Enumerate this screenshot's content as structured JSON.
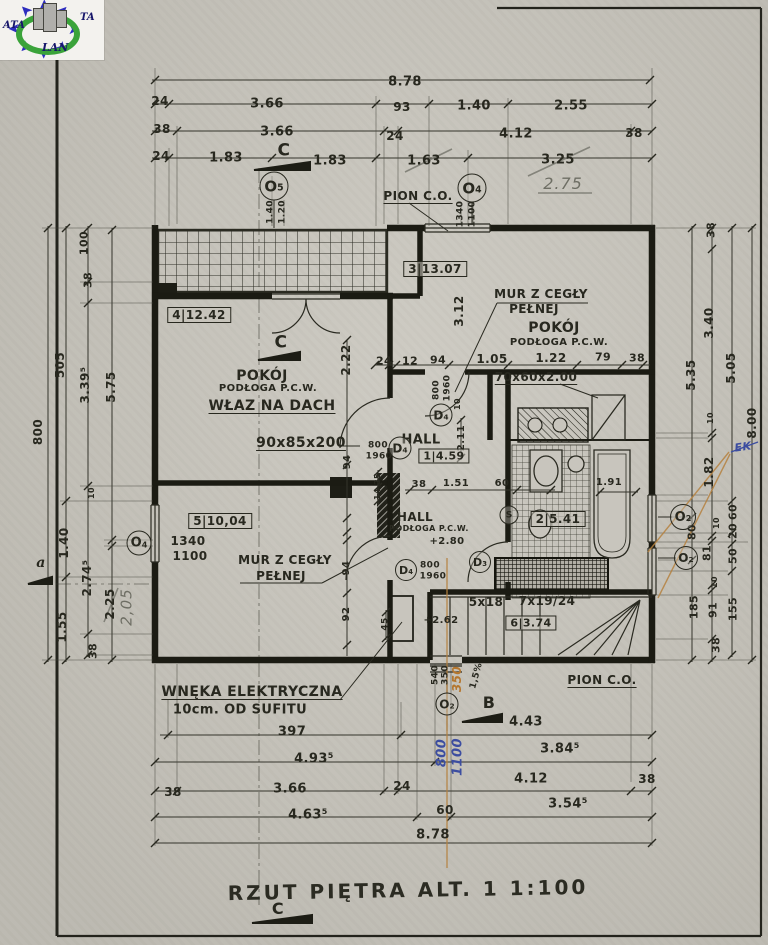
{
  "logo": {
    "text_left": "ATA",
    "text_right": "TA",
    "text_bottom": "LAN"
  },
  "title": {
    "text": "RZUT PIĘTRA ALT. 1  1:100"
  },
  "colors": {
    "paper": "#c8c5bc",
    "ink": "#28281f",
    "pencil": "#6e6e64",
    "blue_ink": "#3c4da0",
    "orange": "#b4762e",
    "logo_blue": "#2d2dbe",
    "logo_green": "#3aa33a"
  },
  "labels": [
    {
      "t": "8.78",
      "x": 405,
      "y": 82,
      "s": 13
    },
    {
      "t": "24",
      "x": 160,
      "y": 101
    },
    {
      "t": "3.66",
      "x": 267,
      "y": 104,
      "s": 13
    },
    {
      "t": "93",
      "x": 402,
      "y": 107
    },
    {
      "t": "1.40",
      "x": 474,
      "y": 106,
      "s": 13
    },
    {
      "t": "2.55",
      "x": 571,
      "y": 106,
      "s": 13
    },
    {
      "t": "38",
      "x": 162,
      "y": 129
    },
    {
      "t": "3.66",
      "x": 277,
      "y": 132,
      "s": 13
    },
    {
      "t": "24",
      "x": 395,
      "y": 136
    },
    {
      "t": "4.12",
      "x": 516,
      "y": 134,
      "s": 13
    },
    {
      "t": "38",
      "x": 634,
      "y": 133
    },
    {
      "t": "24",
      "x": 161,
      "y": 156
    },
    {
      "t": "1.83",
      "x": 226,
      "y": 158,
      "s": 13
    },
    {
      "t": "C",
      "x": 284,
      "y": 151,
      "s": 17,
      "b": 1,
      "n": "section-mark-c-top"
    },
    {
      "t": "1.83",
      "x": 330,
      "y": 161,
      "s": 13
    },
    {
      "t": "1.63",
      "x": 424,
      "y": 161,
      "s": 13
    },
    {
      "t": "3.25",
      "x": 558,
      "y": 160,
      "s": 13
    },
    {
      "t": "2.75",
      "x": 563,
      "y": 184,
      "s": 16,
      "c": "pc",
      "n": "handwritten-correction"
    },
    {
      "t": "PION C.O.",
      "x": 418,
      "y": 196,
      "u": 1,
      "n": "riser-label"
    },
    {
      "t": "1.40",
      "x": 271,
      "y": 212,
      "r": -90,
      "s": 9
    },
    {
      "t": "1.20",
      "x": 283,
      "y": 212,
      "r": -90,
      "s": 9
    },
    {
      "t": "1340",
      "x": 461,
      "y": 214,
      "r": -90,
      "s": 9
    },
    {
      "t": "1100",
      "x": 473,
      "y": 214,
      "r": -90,
      "s": 9
    },
    {
      "t": "3|13.07",
      "x": 435,
      "y": 269,
      "bx": 1,
      "n": "room-tag"
    },
    {
      "t": "MUR Z CEGŁY",
      "x": 541,
      "y": 294,
      "n": "wall-note"
    },
    {
      "t": "PEŁNEJ",
      "x": 534,
      "y": 309,
      "n": "wall-note"
    },
    {
      "t": "POKÓJ",
      "x": 554,
      "y": 328,
      "s": 14,
      "n": "room-name"
    },
    {
      "t": "PODŁOGA P.C.W.",
      "x": 559,
      "y": 343,
      "s": 10,
      "n": "floor-note"
    },
    {
      "t": "3.12",
      "x": 459,
      "y": 311,
      "r": -90
    },
    {
      "t": "24",
      "x": 384,
      "y": 361,
      "s": 11
    },
    {
      "t": "12",
      "x": 410,
      "y": 361,
      "s": 11
    },
    {
      "t": "94",
      "x": 438,
      "y": 360,
      "s": 11
    },
    {
      "t": "1.05",
      "x": 492,
      "y": 359
    },
    {
      "t": "1.22",
      "x": 551,
      "y": 358
    },
    {
      "t": "79",
      "x": 603,
      "y": 357,
      "s": 11
    },
    {
      "t": "38",
      "x": 637,
      "y": 358,
      "s": 11
    },
    {
      "t": "70x60x2.00",
      "x": 536,
      "y": 377,
      "u": 1,
      "n": "duct-size"
    },
    {
      "t": "800",
      "x": 437,
      "y": 390,
      "r": -90,
      "s": 9
    },
    {
      "t": "1960",
      "x": 448,
      "y": 388,
      "r": -90,
      "s": 9
    },
    {
      "t": "10",
      "x": 458,
      "y": 404,
      "r": -90,
      "s": 8
    },
    {
      "t": "2.11",
      "x": 462,
      "y": 438,
      "r": -90,
      "s": 10
    },
    {
      "t": "HALL",
      "x": 421,
      "y": 440,
      "s": 13,
      "n": "room-name"
    },
    {
      "t": "1|4.59",
      "x": 444,
      "y": 456,
      "bx": 1,
      "s": 11,
      "n": "room-tag"
    },
    {
      "t": "800",
      "x": 378,
      "y": 446,
      "s": 9
    },
    {
      "t": "1960",
      "x": 379,
      "y": 457,
      "s": 9
    },
    {
      "t": "38",
      "x": 419,
      "y": 485,
      "s": 10
    },
    {
      "t": "1.51",
      "x": 456,
      "y": 484,
      "s": 10
    },
    {
      "t": "60",
      "x": 502,
      "y": 484,
      "s": 10
    },
    {
      "t": "4|12.42",
      "x": 199,
      "y": 315,
      "bx": 1,
      "n": "room-tag"
    },
    {
      "t": "C",
      "x": 281,
      "y": 343,
      "s": 17,
      "b": 1,
      "n": "section-mark-c"
    },
    {
      "t": "POKÓJ",
      "x": 262,
      "y": 376,
      "s": 14,
      "n": "room-name"
    },
    {
      "t": "PODŁOGA P.C.W.",
      "x": 268,
      "y": 389,
      "s": 10,
      "n": "floor-note"
    },
    {
      "t": "WŁAZ NA DACH",
      "x": 272,
      "y": 406,
      "s": 14,
      "u": 1,
      "n": "roof-hatch-note"
    },
    {
      "t": "90x85x200",
      "x": 301,
      "y": 443,
      "s": 14,
      "u": 1,
      "n": "hatch-size"
    },
    {
      "t": "2.22",
      "x": 346,
      "y": 360,
      "r": -90
    },
    {
      "t": "94",
      "x": 348,
      "y": 462,
      "r": -90,
      "s": 10
    },
    {
      "t": "25",
      "x": 378,
      "y": 479,
      "r": -90,
      "s": 8
    },
    {
      "t": "14",
      "x": 378,
      "y": 494,
      "r": -90,
      "s": 8
    },
    {
      "t": "94",
      "x": 347,
      "y": 568,
      "r": -90,
      "s": 10
    },
    {
      "t": "92",
      "x": 347,
      "y": 614,
      "r": -90,
      "s": 10
    },
    {
      "t": "45",
      "x": 386,
      "y": 624,
      "r": -90,
      "s": 9
    },
    {
      "t": "5|10,04",
      "x": 220,
      "y": 521,
      "bx": 1,
      "n": "room-tag"
    },
    {
      "t": "1340",
      "x": 188,
      "y": 541,
      "n": "window-size"
    },
    {
      "t": "1100",
      "x": 190,
      "y": 556,
      "n": "window-sill"
    },
    {
      "t": "MUR Z CEGŁY",
      "x": 285,
      "y": 560,
      "n": "wall-note"
    },
    {
      "t": "PEŁNEJ",
      "x": 281,
      "y": 576,
      "n": "wall-note"
    },
    {
      "t": "WNĘKA ELEKTRYCZNA",
      "x": 252,
      "y": 692,
      "s": 14,
      "u": 1,
      "n": "niche-note"
    },
    {
      "t": "10cm. OD SUFITU",
      "x": 240,
      "y": 710,
      "s": 13,
      "n": "niche-note"
    },
    {
      "t": "HALL",
      "x": 415,
      "y": 517,
      "n": "room-name"
    },
    {
      "t": "PODŁOGA P.C.W.",
      "x": 429,
      "y": 529,
      "s": 8,
      "n": "floor-note"
    },
    {
      "t": "+2.80",
      "x": 447,
      "y": 542,
      "s": 10,
      "n": "level-mark"
    },
    {
      "t": "800",
      "x": 430,
      "y": 566,
      "s": 9
    },
    {
      "t": "1960",
      "x": 433,
      "y": 577,
      "s": 9
    },
    {
      "t": "2|5.41",
      "x": 558,
      "y": 519,
      "bx": 1,
      "n": "room-tag"
    },
    {
      "t": "1.91",
      "x": 609,
      "y": 483,
      "s": 10
    },
    {
      "t": "+2.62",
      "x": 441,
      "y": 621,
      "s": 10,
      "n": "level-mark"
    },
    {
      "t": "5x18",
      "x": 486,
      "y": 602,
      "n": "stair-note"
    },
    {
      "t": "7x19/24",
      "x": 547,
      "y": 601,
      "n": "stair-note"
    },
    {
      "t": "6|3.74",
      "x": 531,
      "y": 623,
      "bx": 1,
      "s": 11,
      "n": "room-tag"
    },
    {
      "t": "PION C.O.",
      "x": 602,
      "y": 680,
      "u": 1,
      "n": "riser-label"
    },
    {
      "t": "B",
      "x": 489,
      "y": 703,
      "s": 16,
      "b": 1,
      "n": "section-mark-b"
    },
    {
      "t": "1,5%",
      "x": 477,
      "y": 676,
      "r": -75,
      "s": 9,
      "n": "slope-note"
    },
    {
      "t": "540",
      "x": 436,
      "y": 675,
      "r": -90,
      "s": 9
    },
    {
      "t": "350",
      "x": 446,
      "y": 675,
      "r": -90,
      "s": 9
    },
    {
      "t": "350",
      "x": 457,
      "y": 679,
      "r": -90,
      "s": 12,
      "c": "or",
      "n": "handwritten-correction"
    },
    {
      "t": "800",
      "x": 442,
      "y": 753,
      "r": -90,
      "s": 13,
      "c": "bl",
      "n": "handwritten-note"
    },
    {
      "t": "1100",
      "x": 458,
      "y": 757,
      "r": -90,
      "s": 13,
      "c": "bl",
      "n": "handwritten-note"
    },
    {
      "t": "EK",
      "x": 743,
      "y": 447,
      "s": 11,
      "c": "bl",
      "r": -8,
      "n": "handwritten-note"
    },
    {
      "t": "4.43",
      "x": 526,
      "y": 722,
      "s": 13
    },
    {
      "t": "397",
      "x": 292,
      "y": 732,
      "s": 13
    },
    {
      "t": "4.93⁵",
      "x": 314,
      "y": 759,
      "s": 13
    },
    {
      "t": "3.84⁵",
      "x": 560,
      "y": 749,
      "s": 13
    },
    {
      "t": "38",
      "x": 173,
      "y": 792
    },
    {
      "t": "3.66",
      "x": 290,
      "y": 789,
      "s": 13
    },
    {
      "t": "24",
      "x": 402,
      "y": 786
    },
    {
      "t": "4.12",
      "x": 531,
      "y": 779,
      "s": 13
    },
    {
      "t": "38",
      "x": 647,
      "y": 779
    },
    {
      "t": "4.63⁵",
      "x": 308,
      "y": 815,
      "s": 13
    },
    {
      "t": "60",
      "x": 445,
      "y": 810
    },
    {
      "t": "3.54⁵",
      "x": 568,
      "y": 804,
      "s": 13
    },
    {
      "t": "8.78",
      "x": 433,
      "y": 835,
      "s": 13
    },
    {
      "t": "800",
      "x": 38,
      "y": 432,
      "r": -90
    },
    {
      "t": "505",
      "x": 60,
      "y": 365,
      "r": -90
    },
    {
      "t": "100",
      "x": 84,
      "y": 243,
      "r": -90,
      "s": 11
    },
    {
      "t": "38",
      "x": 88,
      "y": 280,
      "r": -90,
      "s": 11
    },
    {
      "t": "3.39⁵",
      "x": 85,
      "y": 385,
      "r": -90
    },
    {
      "t": "5.75",
      "x": 111,
      "y": 387,
      "r": -90
    },
    {
      "t": "10",
      "x": 92,
      "y": 493,
      "r": -90,
      "s": 8
    },
    {
      "t": "1.40",
      "x": 64,
      "y": 543,
      "r": -90
    },
    {
      "t": "2.74⁵",
      "x": 87,
      "y": 578,
      "r": -90
    },
    {
      "t": "2.25",
      "x": 110,
      "y": 604,
      "r": -90
    },
    {
      "t": "2,05",
      "x": 127,
      "y": 607,
      "r": -90,
      "s": 15,
      "c": "pc",
      "n": "handwritten-correction"
    },
    {
      "t": "1.55",
      "x": 62,
      "y": 627,
      "r": -90
    },
    {
      "t": "38",
      "x": 93,
      "y": 651,
      "r": -90,
      "s": 11
    },
    {
      "t": "a",
      "x": 41,
      "y": 563,
      "s": 14,
      "c": "ax",
      "n": "axis-mark-a"
    },
    {
      "t": "5.35",
      "x": 691,
      "y": 375,
      "r": -90
    },
    {
      "t": "80",
      "x": 692,
      "y": 532,
      "r": -90,
      "s": 11
    },
    {
      "t": "185",
      "x": 694,
      "y": 607,
      "r": -90,
      "s": 11
    },
    {
      "t": "38",
      "x": 711,
      "y": 230,
      "r": -90,
      "s": 11
    },
    {
      "t": "3.40",
      "x": 709,
      "y": 323,
      "r": -90
    },
    {
      "t": "10",
      "x": 711,
      "y": 418,
      "r": -90,
      "s": 8
    },
    {
      "t": "1.82",
      "x": 709,
      "y": 472,
      "r": -90
    },
    {
      "t": "10",
      "x": 717,
      "y": 523,
      "r": -90,
      "s": 8
    },
    {
      "t": "81",
      "x": 707,
      "y": 553,
      "r": -90,
      "s": 11
    },
    {
      "t": "10",
      "x": 715,
      "y": 582,
      "r": -90,
      "s": 8
    },
    {
      "t": "91",
      "x": 713,
      "y": 610,
      "r": -90,
      "s": 11
    },
    {
      "t": "38",
      "x": 716,
      "y": 645,
      "r": -90,
      "s": 11
    },
    {
      "t": "5.05",
      "x": 731,
      "y": 368,
      "r": -90
    },
    {
      "t": "60",
      "x": 733,
      "y": 512,
      "r": -90,
      "s": 11
    },
    {
      "t": "20",
      "x": 733,
      "y": 531,
      "r": -90,
      "s": 11
    },
    {
      "t": "50",
      "x": 733,
      "y": 556,
      "r": -90,
      "s": 11
    },
    {
      "t": "155",
      "x": 733,
      "y": 609,
      "r": -90,
      "s": 11
    },
    {
      "t": "8.00",
      "x": 752,
      "y": 423,
      "r": -90
    },
    {
      "t": "C",
      "x": 278,
      "y": 909,
      "s": 16,
      "b": 1,
      "n": "section-mark-c-bottom"
    }
  ],
  "circles": [
    {
      "t": "O5",
      "x": 274,
      "y": 186,
      "d": 27
    },
    {
      "t": "O4",
      "x": 472,
      "y": 188,
      "d": 27
    },
    {
      "t": "O4",
      "x": 139,
      "y": 543,
      "d": 23
    },
    {
      "t": "O2",
      "x": 683,
      "y": 517,
      "d": 24
    },
    {
      "t": "O2",
      "x": 686,
      "y": 558,
      "d": 22
    },
    {
      "t": "O2",
      "x": 447,
      "y": 704,
      "d": 21
    },
    {
      "t": "D4",
      "x": 441,
      "y": 415,
      "d": 21
    },
    {
      "t": "D4",
      "x": 400,
      "y": 448,
      "d": 21
    },
    {
      "t": "D4",
      "x": 406,
      "y": 570,
      "d": 20
    },
    {
      "t": "D3",
      "x": 480,
      "y": 562,
      "d": 20
    },
    {
      "t": "S",
      "x": 509,
      "y": 515,
      "d": 17
    }
  ]
}
